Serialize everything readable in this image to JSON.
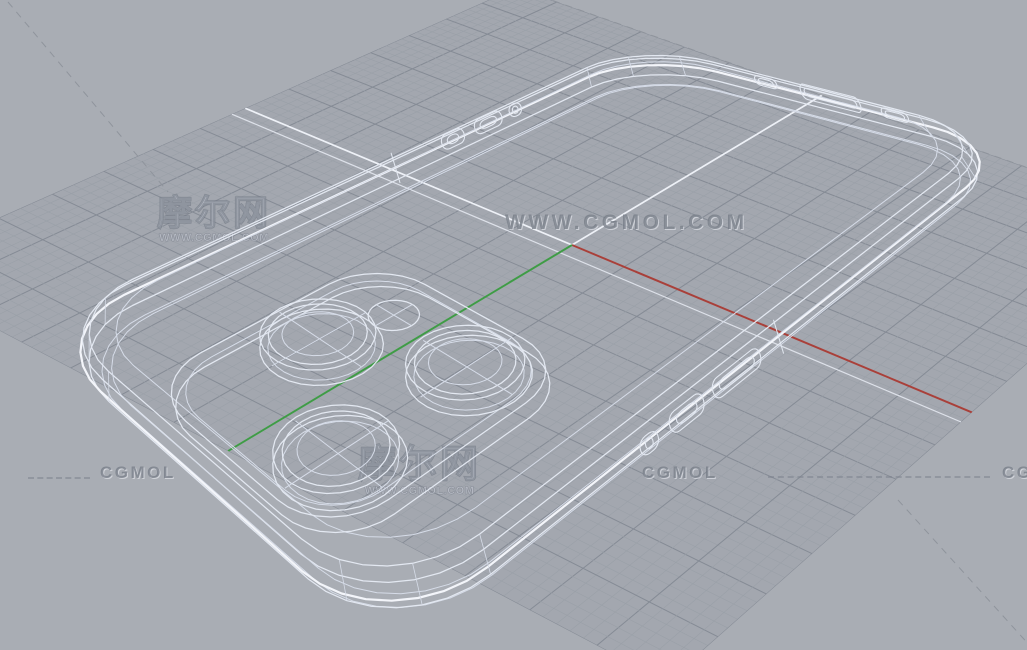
{
  "watermarks": {
    "top_left": {
      "title": "摩尔网",
      "subtitle": "WWW.CGMOL.COM"
    },
    "center": {
      "text": "WWW.CGMOL.COM"
    },
    "mid_lower": {
      "title": "摩尔网",
      "subtitle": "WWW.CGMOL.COM"
    },
    "bottom_left": {
      "text": "CGMOL"
    },
    "bottom_right": {
      "text": "CGMOL"
    },
    "bottom_right_partial": {
      "text": "CGMOL"
    }
  },
  "scene": {
    "background": "#a9adb4",
    "grid_background": "#a3a7af",
    "grid_minor": "#9aa0a8",
    "grid_major": "#858b95",
    "grid_axis_white": "#eef1f7",
    "grid_axis_white_dim": "#dde1e9",
    "axis_x_color": "#a8403a",
    "axis_y_color": "#3f9b46",
    "dashed_line": "#8f949c",
    "model_stroke_bright": "#f3f5fa",
    "model_stroke_mid": "#e3e8f1",
    "model_stroke_thin": "#d6dce8"
  }
}
